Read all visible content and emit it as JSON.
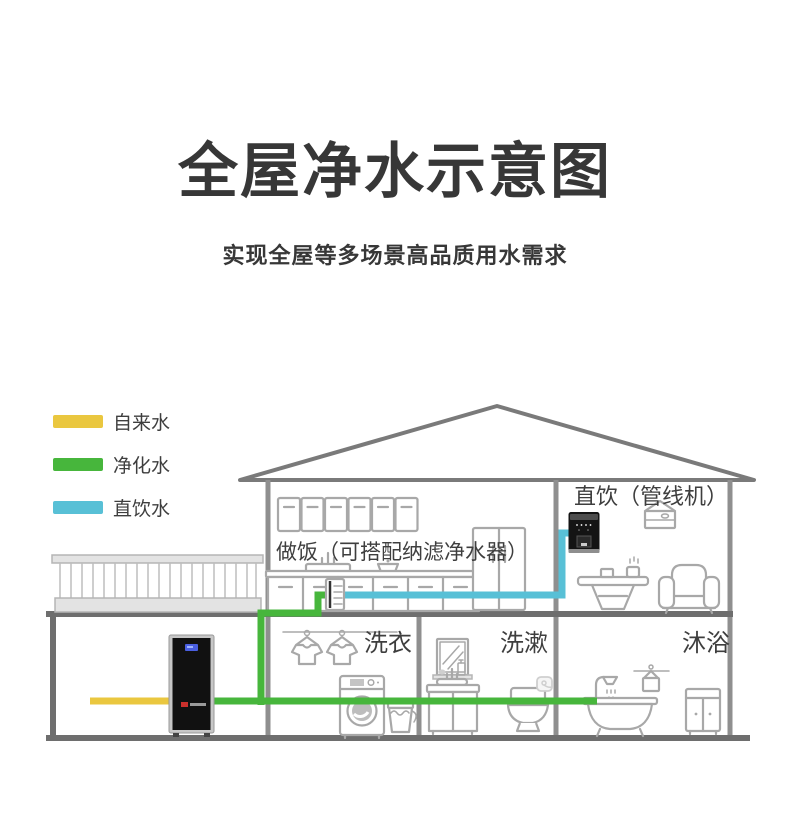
{
  "title": "全屋净水示意图",
  "subtitle": "实现全屋等多场景高品质用水需求",
  "legend": {
    "items": [
      {
        "label": "自来水",
        "color": "#EAC73F"
      },
      {
        "label": "净化水",
        "color": "#47B63C"
      },
      {
        "label": "直饮水",
        "color": "#58C0D6"
      }
    ]
  },
  "rooms": {
    "kitchen": "做饭（可搭配纳滤净水器）",
    "direct_drinking": "直饮（管线机）",
    "laundry": "洗衣",
    "washing": "洗漱",
    "bathing": "沐浴"
  },
  "icons": [
    "roof",
    "balcony-railing",
    "whole-house-purifier",
    "kitchen-upper-cabinets",
    "kitchen-lower-cabinets",
    "kitchen-sink",
    "cooking-pot",
    "refrigerator",
    "under-sink-filter",
    "pipeline-water-dispenser",
    "wall-cabinet",
    "tea-table",
    "armchair",
    "clothesline-shirts",
    "washing-machine",
    "bucket",
    "mirror",
    "bathroom-vanity",
    "toilet",
    "toilet-paper",
    "bathtub",
    "shower-faucet",
    "towel-hanger",
    "bathroom-cabinet",
    "tap-water-pipe",
    "purified-water-pipe",
    "direct-water-pipe"
  ],
  "colors": {
    "tap_water": "#EAC73F",
    "purified_water": "#47B63C",
    "direct_water": "#58C0D6",
    "wall": "#8F8F8F",
    "wall_dark": "#6E6E6E",
    "roof": "#7A7A7A",
    "icon_stroke": "#A8A8A8",
    "title_text": "#373737",
    "body_text": "#3E3E3E",
    "fill_light": "#E3E3E3",
    "device_black": "#141414",
    "display_blue": "#4A5FE0",
    "logo_red": "#C9302C"
  }
}
